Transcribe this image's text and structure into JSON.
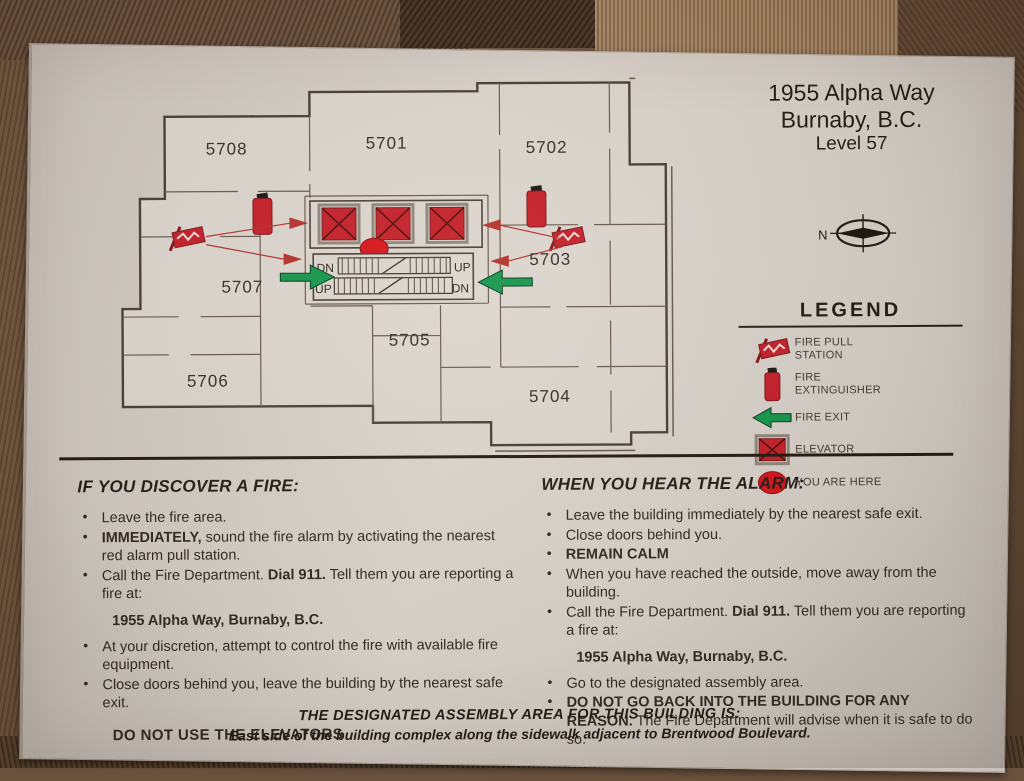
{
  "title": {
    "line1": "1955 Alpha Way",
    "line2": "Burnaby, B.C.",
    "line3": "Level 57"
  },
  "compass": {
    "north_label": "N"
  },
  "floorplan": {
    "rooms": [
      {
        "label": "5708"
      },
      {
        "label": "5701"
      },
      {
        "label": "5702"
      },
      {
        "label": "5707"
      },
      {
        "label": "5703"
      },
      {
        "label": "5705"
      },
      {
        "label": "5706"
      },
      {
        "label": "5704"
      }
    ],
    "stairs": {
      "top_left": "DN",
      "top_right": "UP",
      "bottom_left": "UP",
      "bottom_right": "DN"
    }
  },
  "legend": {
    "title": "LEGEND",
    "items": [
      {
        "label": "FIRE PULL STATION",
        "icon": "fire-pull-station-icon"
      },
      {
        "label": "FIRE EXTINGUISHER",
        "icon": "fire-extinguisher-icon"
      },
      {
        "label": "FIRE EXIT",
        "icon": "fire-exit-arrow-icon"
      },
      {
        "label": "ELEVATOR",
        "icon": "elevator-icon"
      },
      {
        "label": "YOU ARE HERE",
        "icon": "you-are-here-icon"
      }
    ]
  },
  "discover": {
    "heading": "IF YOU DISCOVER A FIRE:",
    "bullets1": [
      {
        "t1": "Leave the fire area.",
        "b": "",
        "t2": ""
      },
      {
        "t1": "",
        "b": "IMMEDIATELY,",
        "t2": " sound the fire alarm by activating the nearest red alarm pull station."
      },
      {
        "t1": "Call the Fire Department.  ",
        "b": "Dial 911.",
        "t2": "  Tell them you are reporting a fire at:"
      }
    ],
    "address": "1955 Alpha Way, Burnaby, B.C.",
    "bullets2": [
      {
        "t1": "At your discretion, attempt to control the fire with available fire equipment.",
        "b": "",
        "t2": ""
      },
      {
        "t1": "Close doors behind you, leave the building by the nearest safe exit.",
        "b": "",
        "t2": ""
      }
    ],
    "footer": "DO NOT USE THE ELEVATORS"
  },
  "alarm": {
    "heading": "WHEN YOU HEAR THE ALARM:",
    "bullets1": [
      {
        "t1": "Leave the building immediately by the nearest safe exit.",
        "b": "",
        "t2": ""
      },
      {
        "t1": "Close doors behind you.",
        "b": "",
        "t2": ""
      },
      {
        "t1": "",
        "b": "REMAIN CALM",
        "t2": ""
      },
      {
        "t1": "When you have reached the outside, move away from the building.",
        "b": "",
        "t2": ""
      },
      {
        "t1": "Call the Fire Department.  ",
        "b": "Dial 911.",
        "t2": "  Tell them you are reporting a fire at:"
      }
    ],
    "address": "1955 Alpha Way, Burnaby, B.C.",
    "bullets2": [
      {
        "t1": "Go to the designated assembly area.",
        "b": "",
        "t2": ""
      },
      {
        "t1": "",
        "b": "DO NOT GO BACK INTO THE BUILDING FOR ANY REASON.",
        "t2": "  The Fire Department will advise when it is safe to do so."
      }
    ]
  },
  "assembly": {
    "line1": "THE DESIGNATED ASSEMBLY AREA FOR THIS BUILDING IS:",
    "line2": "East side of the building complex along the sidewalk adjacent to Brentwood Boulevard."
  },
  "colors": {
    "red": "#c5202a",
    "green": "#16984d",
    "ink": "#332b25",
    "wall_line": "#554a3e",
    "sign_bg": "#d7d1ca"
  }
}
